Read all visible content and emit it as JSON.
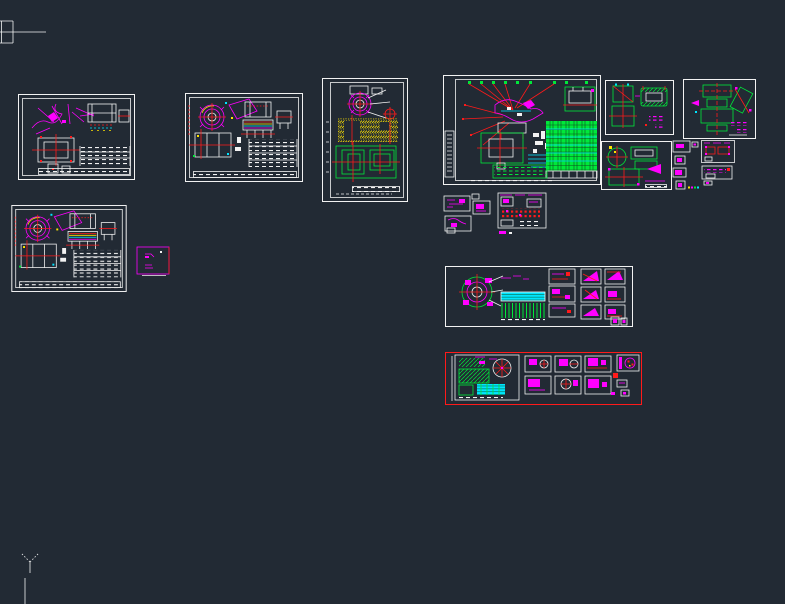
{
  "app": {
    "kind": "cad-model-space-viewport",
    "visible_text": "none (all drawing annotation below legibility threshold)"
  },
  "canvas": {
    "width": 785,
    "height": 604
  },
  "palette": {
    "bg": "#222a34",
    "white": "#f2f2f2",
    "red": "#ff1a1a",
    "green": "#00e83a",
    "cyan": "#00e5ff",
    "magenta": "#ff00ff",
    "yellow": "#ffe400",
    "table_grid_dark": "#0c4f22"
  },
  "ucs_marker": {
    "glyph": "Y-axis-tree",
    "color": "#f2f2f2",
    "x": 17,
    "y": 550
  },
  "sheets": [
    {
      "id": "frag-topleft",
      "name": "clipped-drawing-fragment",
      "x": 0,
      "y": 17,
      "w": 50,
      "h": 28,
      "border": "#f2f2f2"
    },
    {
      "id": "sheet-a",
      "name": "assembly-sheet-1",
      "x": 18,
      "y": 94,
      "w": 117,
      "h": 86,
      "border": "#f2f2f2"
    },
    {
      "id": "sheet-b",
      "name": "assembly-sheet-2",
      "x": 185,
      "y": 93,
      "w": 118,
      "h": 89,
      "border": "#f2f2f2"
    },
    {
      "id": "sheet-c",
      "name": "portrait-install-sheet",
      "x": 322,
      "y": 78,
      "w": 86,
      "h": 124,
      "border": "#f2f2f2"
    },
    {
      "id": "sheet-d",
      "name": "large-layout-sheet",
      "x": 443,
      "y": 75,
      "w": 158,
      "h": 110,
      "border": "#f2f2f2"
    },
    {
      "id": "sheet-e",
      "name": "part-sheet-1",
      "x": 605,
      "y": 80,
      "w": 69,
      "h": 55,
      "border": "#f2f2f2"
    },
    {
      "id": "sheet-f",
      "name": "part-sheet-2",
      "x": 683,
      "y": 79,
      "w": 73,
      "h": 60,
      "border": "#f2f2f2"
    },
    {
      "id": "sheet-g",
      "name": "part-sheet-3",
      "x": 601,
      "y": 141,
      "w": 71,
      "h": 49,
      "border": "#f2f2f2"
    },
    {
      "id": "cluster-h",
      "name": "small-detail-boxes",
      "x": 672,
      "y": 140,
      "w": 28,
      "h": 58,
      "border": "none"
    },
    {
      "id": "detail-i",
      "name": "detail-view-pair",
      "x": 701,
      "y": 140,
      "w": 48,
      "h": 46,
      "border": "#f2f2f2"
    },
    {
      "id": "sheet-j",
      "name": "assembly-sheet-3",
      "x": 10,
      "y": 205,
      "w": 118,
      "h": 87,
      "border": "#f2f2f2"
    },
    {
      "id": "box-k",
      "name": "selected-symbol-box",
      "x": 136,
      "y": 246,
      "w": 36,
      "h": 31,
      "border": "#ff00ff"
    },
    {
      "id": "cluster-l",
      "name": "schematic-fragment-group",
      "x": 443,
      "y": 192,
      "w": 106,
      "h": 43,
      "border": "none"
    },
    {
      "id": "sheet-m",
      "name": "multi-panel-sheet",
      "x": 445,
      "y": 266,
      "w": 188,
      "h": 61,
      "border": "#f2f2f2"
    },
    {
      "id": "sheet-n",
      "name": "red-framed-panel-sheet",
      "x": 445,
      "y": 352,
      "w": 197,
      "h": 53,
      "border": "#ff1a1a"
    },
    {
      "id": "y-marker",
      "name": "ucs-y-axis-marker",
      "x": 17,
      "y": 550,
      "w": 26,
      "h": 26,
      "border": "none"
    },
    {
      "id": "edge-line",
      "name": "clipped-vertical-line",
      "x": 24,
      "y": 578,
      "w": 2,
      "h": 26,
      "border": "none"
    }
  ]
}
